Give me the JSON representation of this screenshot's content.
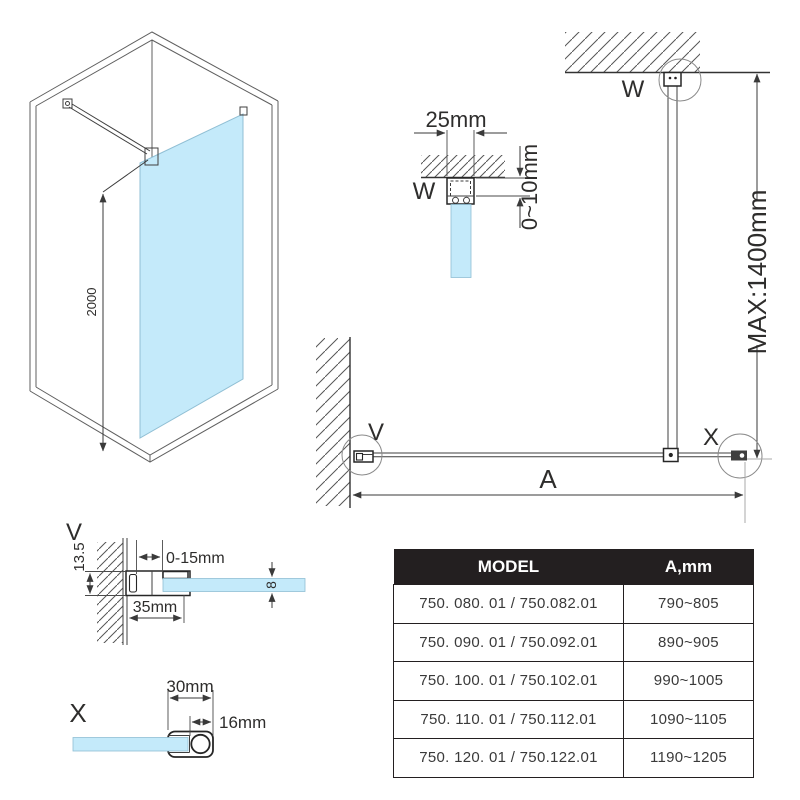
{
  "colors": {
    "glass_fill": "#c4eafa",
    "glass_stroke": "#90bfd4",
    "line": "#3f3f3f",
    "dark": "#231f20",
    "table_header_bg": "#231f20",
    "table_header_text": "#ffffff"
  },
  "iso": {
    "height_dim": "2000"
  },
  "w_section": {
    "label": "W",
    "width_dim": "25mm",
    "gap_dim": "0~10mm"
  },
  "plan": {
    "ceiling_label": "W",
    "max_dim": "MAX:1400mm",
    "wall_label": "V",
    "end_label": "X",
    "width_dim": "A"
  },
  "v_detail": {
    "label": "V",
    "depth_dim": "13.5",
    "adjust_dim": "0-15mm",
    "profile_dim": "35mm",
    "glass_dim": "8"
  },
  "x_detail": {
    "label": "X",
    "width_dim": "30mm",
    "bar_dim": "16mm"
  },
  "table": {
    "headers": [
      "MODEL",
      "A,mm"
    ],
    "rows": [
      {
        "model": "750. 080. 01 / 750.082.01",
        "a_mm": "790~805"
      },
      {
        "model": "750. 090. 01 / 750.092.01",
        "a_mm": "890~905"
      },
      {
        "model": "750. 100. 01 / 750.102.01",
        "a_mm": "990~1005"
      },
      {
        "model": "750. 110. 01 / 750.112.01",
        "a_mm": "1090~1105"
      },
      {
        "model": "750. 120. 01 / 750.122.01",
        "a_mm": "1190~1205"
      }
    ]
  }
}
